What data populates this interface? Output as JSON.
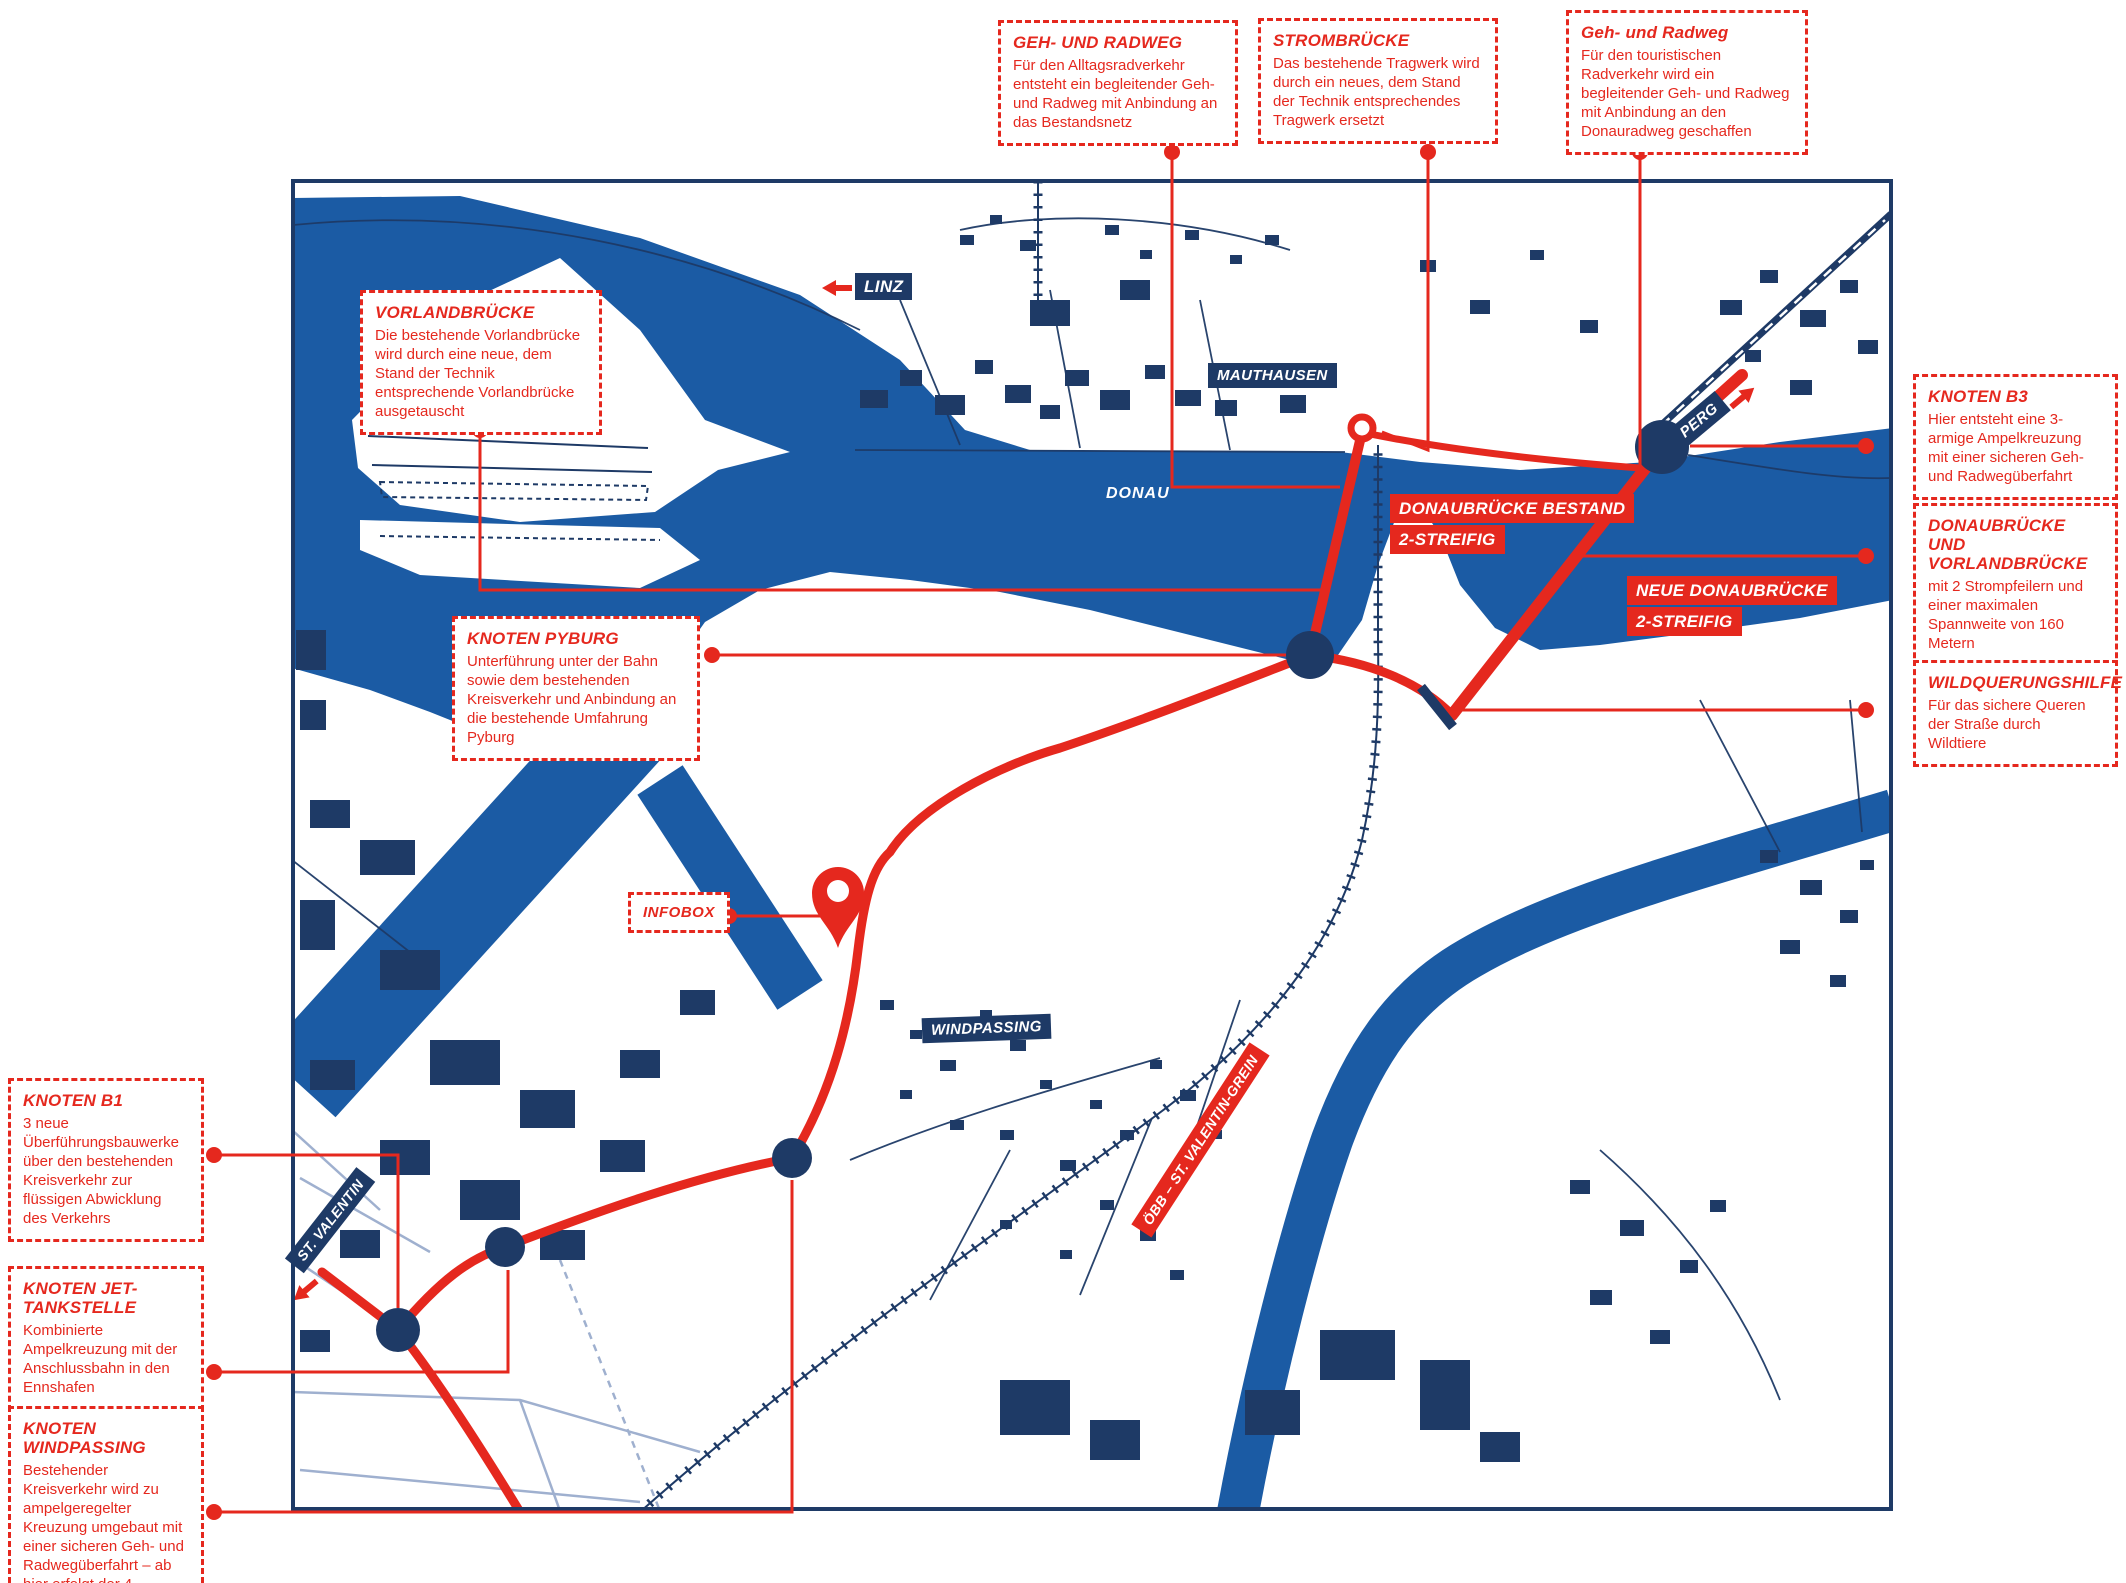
{
  "colors": {
    "red": "#e5281e",
    "navy": "#1e3a66",
    "river_blue": "#1b5ba4"
  },
  "map": {
    "labels": {
      "linz": "LINZ",
      "mauthausen": "MAUTHAUSEN",
      "donau": "DONAU",
      "perg": "PERG",
      "ennskanal": "ENNSKANAL",
      "windpassing": "WINDPASSING",
      "st_valentin": "ST. VALENTIN",
      "oebb_line": "ÖBB – ST. VALENTIN-GREIN",
      "infobox": "INFOBOX",
      "donaubruecke_bestand_line1": "DONAUBRÜCKE BESTAND",
      "donaubruecke_bestand_line2": "2-STREIFIG",
      "neue_donaubruecke_line1": "NEUE DONAUBRÜCKE",
      "neue_donaubruecke_line2": "2-STREIFIG"
    },
    "markers": {
      "strombruecke_ring": "ring-marker",
      "infobox_pin": "location-pin",
      "wildquerung_bar": "wildlife-crossing-bar"
    }
  },
  "callouts": {
    "geh_radweg_alltag": {
      "title": "GEH- UND RADWEG",
      "body": "Für den Alltagsradverkehr entsteht ein begleitender Geh- und Radweg mit Anbindung an das Bestandsnetz"
    },
    "strombruecke": {
      "title": "STROMBRÜCKE",
      "body": "Das bestehende Tragwerk wird durch ein neues, dem Stand der Technik entsprechendes Tragwerk ersetzt"
    },
    "geh_radweg_tourist": {
      "title": "Geh- und Radweg",
      "body": "Für den touristischen Radverkehr wird ein begleitender Geh- und Radweg mit Anbindung an den Donauradweg geschaffen"
    },
    "vorlandbruecke": {
      "title": "VORLANDBRÜCKE",
      "body": "Die bestehende Vorlandbrücke wird durch eine neue, dem Stand der Technik entsprechende Vorlandbrücke ausgetauscht"
    },
    "knoten_pyburg": {
      "title": "KNOTEN PYBURG",
      "body": "Unterführung unter der Bahn sowie dem bestehenden Kreisverkehr und Anbindung an die bestehende Umfahrung Pyburg"
    },
    "knoten_b1": {
      "title": "KNOTEN B1",
      "body": "3 neue Überführungsbauwerke über den bestehenden Kreisverkehr zur flüssigen Abwicklung des Verkehrs"
    },
    "knoten_jet": {
      "title": "KNOTEN JET-TANKSTELLE",
      "body": "Kombinierte Ampelkreuzung mit der Anschlussbahn in den Ennshafen"
    },
    "knoten_windpassing": {
      "title": "KNOTEN WINDPASSING",
      "body": "Bestehender Kreisverkehr wird zu ampelgeregelter Kreuzung umgebaut mit einer sicheren Geh- und Radwegüberfahrt – ab hier erfolgt der 4-streifige Ausbau der B123"
    },
    "knoten_b3": {
      "title": "KNOTEN B3",
      "body": "Hier entsteht eine 3-armige Ampelkreuzung mit einer sicheren Geh- und Radwegüberfahrt"
    },
    "donaubruecke_vorlandbruecke": {
      "title": "DONAUBRÜCKE UND VORLANDBRÜCKE",
      "body": "mit 2 Strompfeilern und einer maximalen Spannweite von 160 Metern"
    },
    "wildquerungshilfe": {
      "title": "WILDQUERUNGSHILFE",
      "body": "Für das sichere Queren der Straße durch Wildtiere"
    }
  }
}
